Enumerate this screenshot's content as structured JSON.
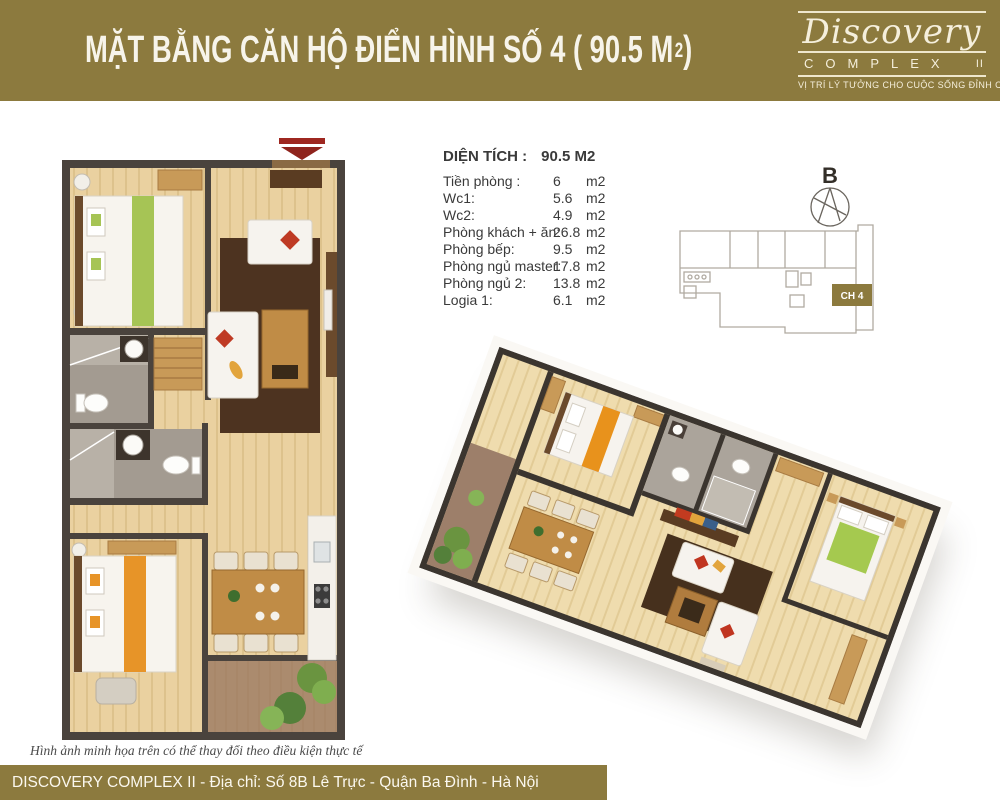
{
  "header": {
    "title_main": "MẶT BẰNG CĂN HỘ ĐIỂN HÌNH SỐ 4 ( 90.5 M",
    "title_sup": "2",
    "title_end": ")",
    "bg_color": "#8c7a3e"
  },
  "logo": {
    "brand": "Discovery",
    "complex_word": "COMPLEX",
    "complex_suffix": "II",
    "tagline": "VỊ TRÍ LÝ TƯỞNG CHO CUỘC SỐNG ĐỈNH CAO"
  },
  "area_table": {
    "title_label": "DIỆN TÍCH :",
    "title_value": "90.5 M2",
    "rows": [
      {
        "label": "Tiền phòng :",
        "value": "6",
        "unit": "m2"
      },
      {
        "label": "Wc1:",
        "value": "5.6",
        "unit": "m2"
      },
      {
        "label": "Wc2:",
        "value": "4.9",
        "unit": "m2"
      },
      {
        "label": "Phòng khách + ăn:",
        "value": "26.8",
        "unit": "m2"
      },
      {
        "label": "Phòng bếp:",
        "value": "9.5",
        "unit": "m2"
      },
      {
        "label": "Phòng ngủ master:",
        "value": "17.8",
        "unit": "m2"
      },
      {
        "label": "Phòng ngủ 2:",
        "value": "13.8",
        "unit": "m2"
      },
      {
        "label": "Logia 1:",
        "value": "6.1",
        "unit": "m2"
      }
    ]
  },
  "key_plan": {
    "north_label": "B",
    "unit_label": "CH 4",
    "highlight_color": "#8c7a3e"
  },
  "footnote": "Hình ảnh minh họa trên có thể thay đổi theo điều kiện thực tế",
  "footer": {
    "text": "DISCOVERY COMPLEX II - Địa chỉ: Số 8B Lê Trực - Quận Ba Đình - Hà Nội",
    "bg_color": "#8c7a3e"
  },
  "icons": {
    "entrance_arrow": "down-arrow-entrance-marker",
    "compass": "compass-north"
  },
  "colors": {
    "accent_olive": "#8c7a3e",
    "arrow_red": "#9e2720",
    "wall_dark": "#4a433d",
    "wood_floor": "#ead1a0",
    "rug_brown": "#4d3320",
    "green_accent": "#a6c455",
    "orange_accent": "#e79428",
    "red_cushion": "#bf3a24",
    "balcony_tile": "#9b7c67"
  }
}
